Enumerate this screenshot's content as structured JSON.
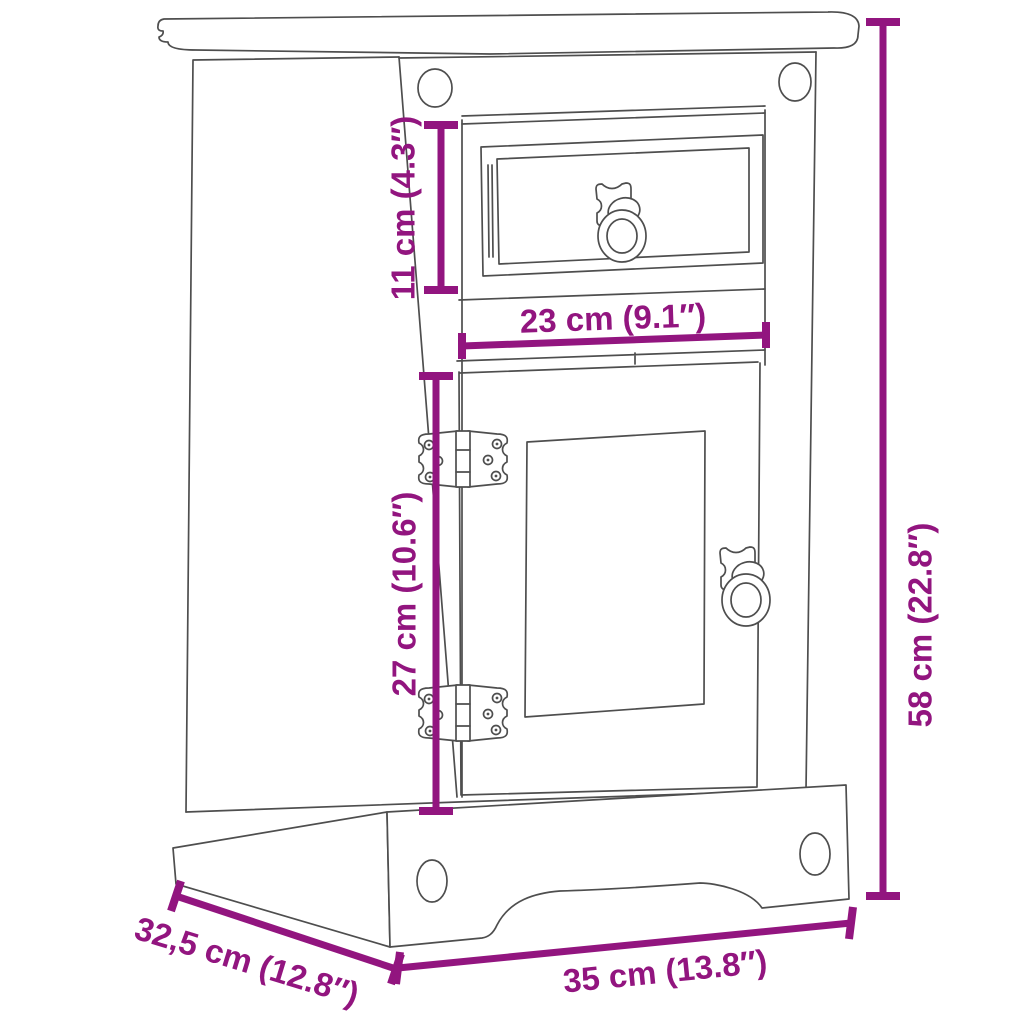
{
  "diagram": {
    "kind": "product dimension diagram",
    "subject": "bedside cabinet with one drawer and one door",
    "colors": {
      "accent": "#92157f",
      "line": "#4e4e4e",
      "background": "#ffffff"
    },
    "dimensions": {
      "drawer_height": "11 cm (4.3″)",
      "drawer_width": "23 cm (9.1″)",
      "door_height": "27 cm (10.6″)",
      "overall_height": "58 cm (22.8″)",
      "depth": "32,5 cm (12.8″)",
      "overall_width": "35 cm (13.8″)"
    }
  }
}
